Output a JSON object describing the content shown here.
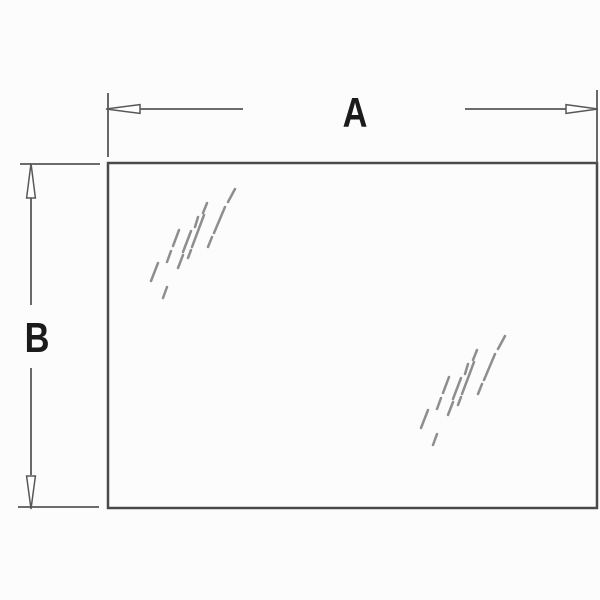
{
  "diagram": {
    "labels": {
      "width_dimension": "A",
      "height_dimension": "B"
    },
    "colors": {
      "background": "#fcfcfc",
      "panel_line": "#4a4a4a",
      "dimension_line": "#585858",
      "label_text": "#1b1b1b",
      "shine_mark": "#8e8e8e",
      "arrow_fill": "#ffffff"
    },
    "shine_marks": {
      "pattern": [
        [
          83,
          16,
          90,
          3
        ],
        [
          69,
          47,
          80,
          21
        ],
        [
          63,
          61,
          67,
          51
        ],
        [
          58,
          27,
          62,
          17
        ],
        [
          47,
          61,
          59,
          29
        ],
        [
          43,
          72,
          46,
          64
        ],
        [
          50,
          41,
          53,
          31
        ],
        [
          38,
          66,
          46,
          45
        ],
        [
          28,
          60,
          34,
          44
        ],
        [
          22,
          76,
          26,
          65
        ],
        [
          33,
          82,
          38,
          69
        ],
        [
          6,
          95,
          13,
          77
        ],
        [
          18,
          112,
          22,
          101
        ]
      ],
      "groups": [
        {
          "x": 145,
          "y": 186
        },
        {
          "x": 415,
          "y": 333
        }
      ]
    }
  }
}
